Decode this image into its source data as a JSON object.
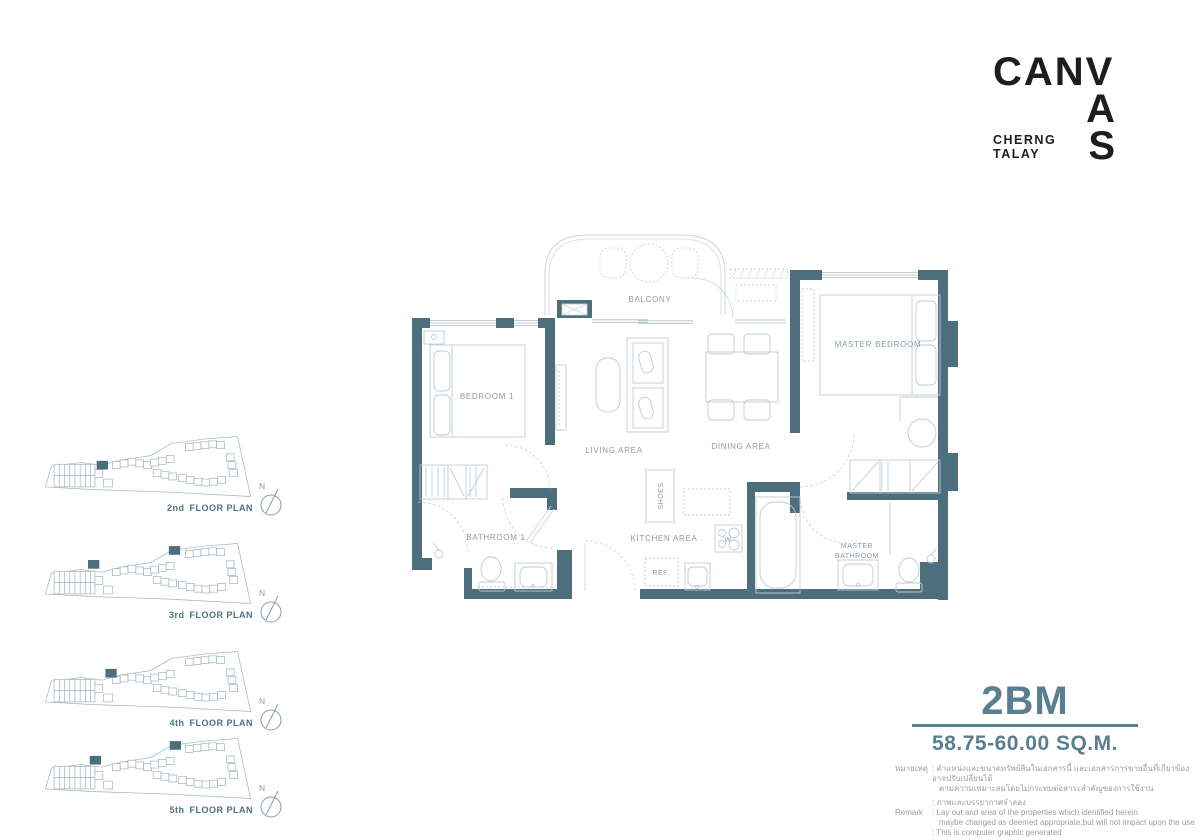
{
  "colors": {
    "wall": "#4d6e7d",
    "accent": "#597e8f",
    "line": "#c5cfd6",
    "label": "#8a9ca6"
  },
  "logo": {
    "line1": "CANV",
    "line2": "A",
    "line3": "S",
    "sub1": "CHERNG",
    "sub2": "TALAY"
  },
  "unit": {
    "type": "2BM",
    "area": "58.75-60.00 SQ.M."
  },
  "plan": {
    "balcony": "BALCONY",
    "bedroom1": "BEDROOM 1",
    "master_bedroom": "MASTER BEDROOM",
    "living": "LIVING AREA",
    "dining": "DINING AREA",
    "shoes": "SHOES",
    "kitchen": "KITCHEN AREA",
    "washer": "W",
    "ref": "REF.",
    "bathroom1": "BATHROOM 1",
    "master_bath_line1": "MASTER",
    "master_bath_line2": "BATHROOM"
  },
  "north_label": "N",
  "floors": [
    {
      "ordinal": "2nd",
      "suffix": "FLOOR PLAN",
      "highlights": [
        [
          66,
          32
        ]
      ]
    },
    {
      "ordinal": "3rd",
      "suffix": "FLOOR PLAN",
      "highlights": [
        [
          56,
          23
        ],
        [
          149,
          7
        ]
      ]
    },
    {
      "ordinal": "4th",
      "suffix": "FLOOR PLAN",
      "highlights": [
        [
          76,
          24
        ]
      ]
    },
    {
      "ordinal": "5th",
      "suffix": "FLOOR PLAN",
      "highlights": [
        [
          58,
          24
        ],
        [
          150,
          7
        ]
      ]
    }
  ],
  "remark": {
    "thai_label": "หมายเหตุ",
    "thai_line1": ": ตำแหน่งและขนาดทรัพย์สินในเอกสารนี้ และเอกสารการขายอื่นที่เกี่ยวข้อง อาจปรับเปลี่ยนได้",
    "thai_line2": "ตามความเหมาะสมโดยไม่กระทบต่อสาระสำคัญของการใช้งาน",
    "thai_line3": ": ภาพและบรรยากาศจำลอง",
    "en_label": "Remark",
    "en_line1": ": Lay out and area of the properties which identified herein",
    "en_line2": "maybe changed as deemed appropriate,but will not impact upon the use",
    "en_line3": ": This is computer graphic generated"
  }
}
